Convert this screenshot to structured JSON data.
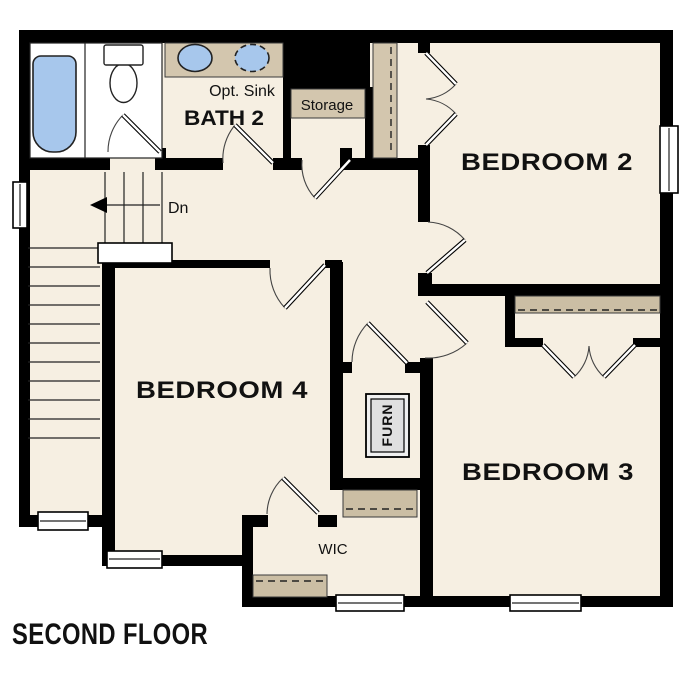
{
  "title": "SECOND FLOOR",
  "palette": {
    "wall": "#000000",
    "floor": "#f6efe2",
    "accent_tan": "#d3c6ae",
    "shelf_tan": "#cbbea4",
    "fixture_blue": "#a7c7ec",
    "furnace_gray": "#e0e0e0",
    "background": "#ffffff"
  },
  "rooms": {
    "bath": {
      "label": "BATH 2",
      "opt_sink_label": "Opt. Sink"
    },
    "storage": {
      "label": "Storage"
    },
    "bedroom2": {
      "label": "BEDROOM 2"
    },
    "bedroom3": {
      "label": "BEDROOM 3"
    },
    "bedroom4": {
      "label": "BEDROOM 4"
    },
    "wic": {
      "label": "WIC"
    },
    "furnace": {
      "label": "FURN"
    },
    "stairs": {
      "direction_label": "Dn"
    }
  }
}
